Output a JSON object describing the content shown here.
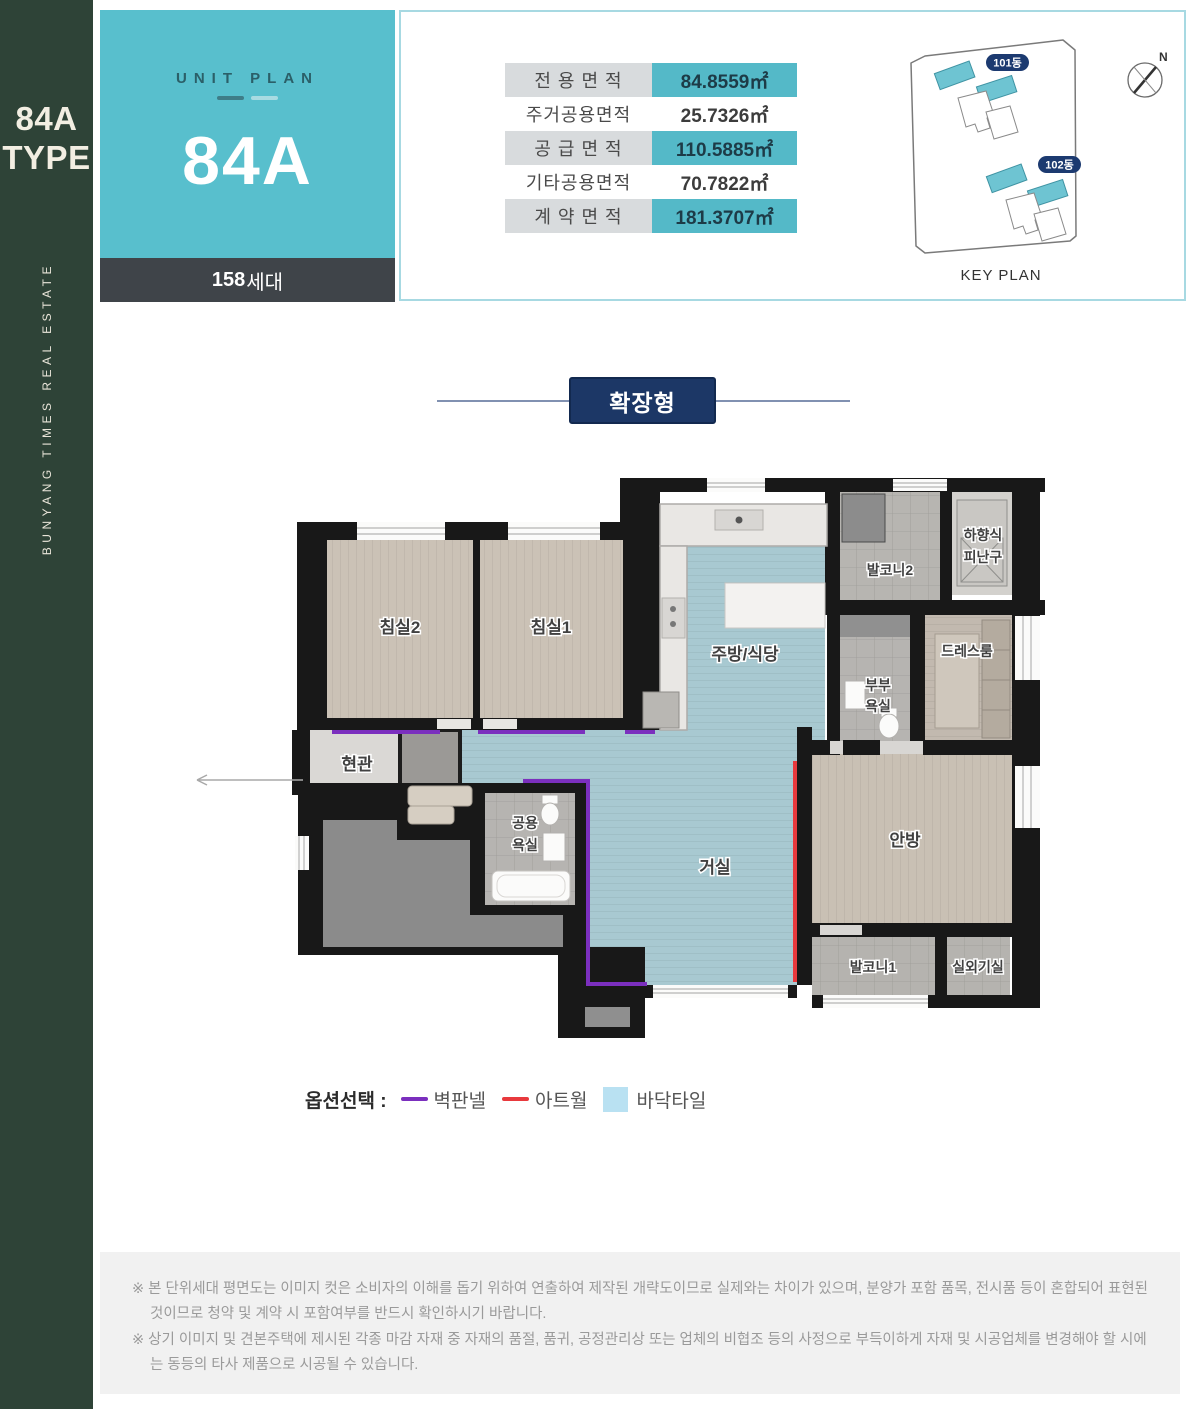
{
  "sidebar": {
    "type_line1": "84A",
    "type_line2": "TYPE",
    "vertical_text": "BUNYANG TIMES REAL ESTATE"
  },
  "unit_plan": {
    "eyebrow": "UNIT PLAN",
    "code": "84A",
    "units_count": "158",
    "units_suffix": "세대"
  },
  "area_table": {
    "rows": [
      {
        "label": "전 용 면 적",
        "value": "84.8559㎡",
        "highlighted": true
      },
      {
        "label": "주거공용면적",
        "value": "25.7326㎡",
        "highlighted": false
      },
      {
        "label": "공 급 면 적",
        "value": "110.5885㎡",
        "highlighted": true
      },
      {
        "label": "기타공용면적",
        "value": "70.7822㎡",
        "highlighted": false
      },
      {
        "label": "계 약 면 적",
        "value": "181.3707㎡",
        "highlighted": true
      }
    ]
  },
  "key_plan": {
    "caption": "KEY PLAN",
    "building1": "101동",
    "building2": "102동",
    "compass": "N",
    "accent_color": "#6ec4d2",
    "pill_color": "#1c3a70"
  },
  "expand": {
    "label": "확장형"
  },
  "floor_plan": {
    "rooms": {
      "bedroom2": "침실2",
      "bedroom1": "침실1",
      "kitchen": "주방/식당",
      "balcony2": "발코니2",
      "evac_line1": "하향식",
      "evac_line2": "피난구",
      "mbath_line1": "부부",
      "mbath_line2": "욕실",
      "dressroom": "드레스룸",
      "entrance": "현관",
      "cbath_line1": "공용",
      "cbath_line2": "욕실",
      "living": "거실",
      "master_bedroom": "안방",
      "balcony1": "발코니1",
      "ac_room": "실외기실"
    },
    "option_colors": {
      "wall_panel": "#7b2fbe",
      "art_wall": "#e8393d",
      "floor_tile": "#a8c9d1"
    }
  },
  "legend": {
    "title": "옵션선택 :",
    "item1": "벽판넬",
    "item2": "아트월",
    "item3": "바닥타일"
  },
  "disclaimer": {
    "line1": "※ 본 단위세대 평면도는 이미지 컷은 소비자의 이해를 돕기 위하여 연출하여 제작된 개략도이므로 실제와는 차이가 있으며, 분양가 포함 품목, 전시품 등이 혼합되어 표현된 것이므로 청약 및 계약 시 포함여부를 반드시 확인하시기 바랍니다.",
    "line2": "※ 상기 이미지 및 견본주택에 제시된 각종 마감 자재 중 자재의 품절, 품귀, 공정관리상 또는 업체의 비협조 등의 사정으로 부득이하게 자재 및 시공업체를 변경해야 할 시에는 동등의 타사 제품으로 시공될 수 있습니다."
  },
  "colors": {
    "sidebar_green": "#2e4337",
    "teal": "#58bfcd",
    "table_highlight": "#54b9c8",
    "navy": "#1c3766",
    "wall_black": "#181818"
  }
}
